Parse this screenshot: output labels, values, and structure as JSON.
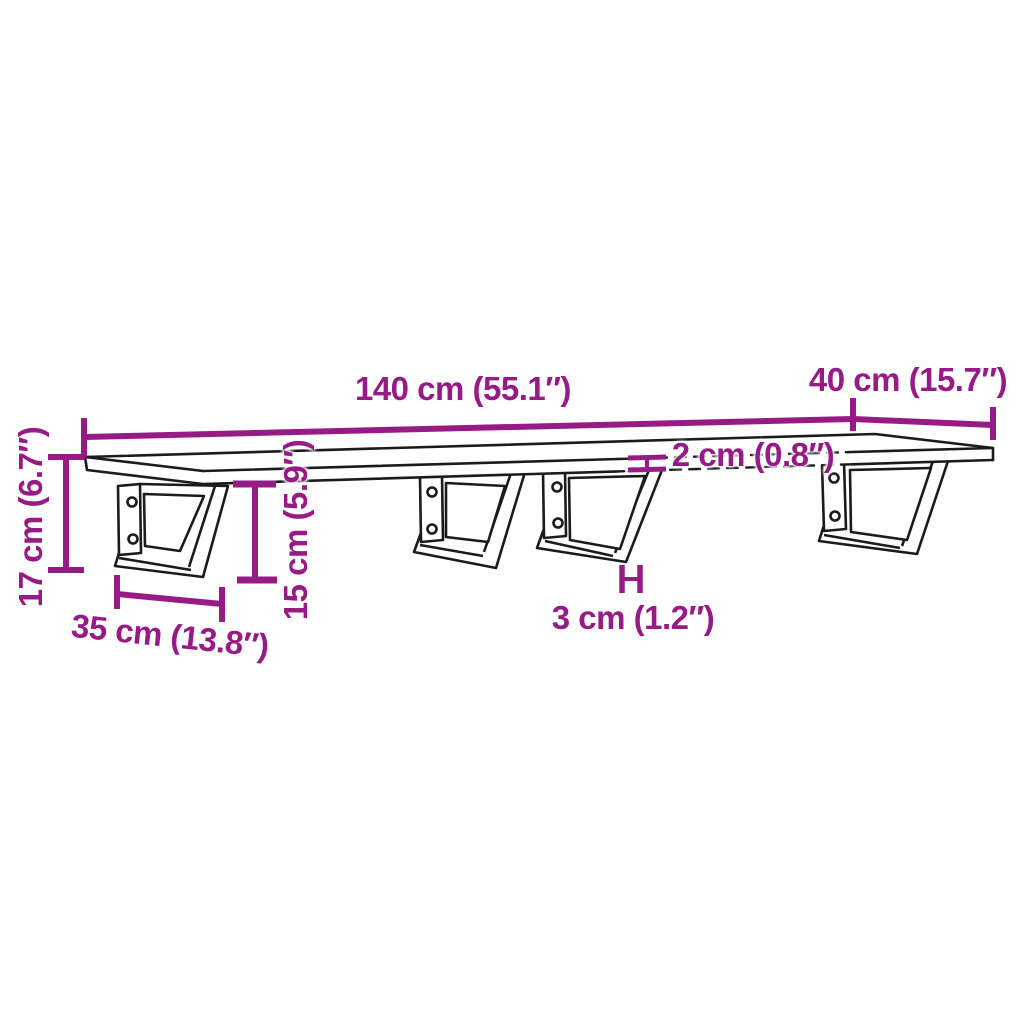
{
  "diagram": {
    "colors": {
      "accent": "#971B85",
      "line": "#1b1b1b",
      "background": "#ffffff"
    },
    "labels": {
      "board_length": "140 cm (55.1″)",
      "board_depth": "40 cm (15.7″)",
      "board_thickness": "2 cm (0.8″)",
      "overall_height": "17 cm (6.7″)",
      "bracket_height": "15 cm (5.9″)",
      "bracket_depth": "35 cm (13.8″)",
      "bracket_bar_width": "3 cm (1.2″)"
    }
  }
}
